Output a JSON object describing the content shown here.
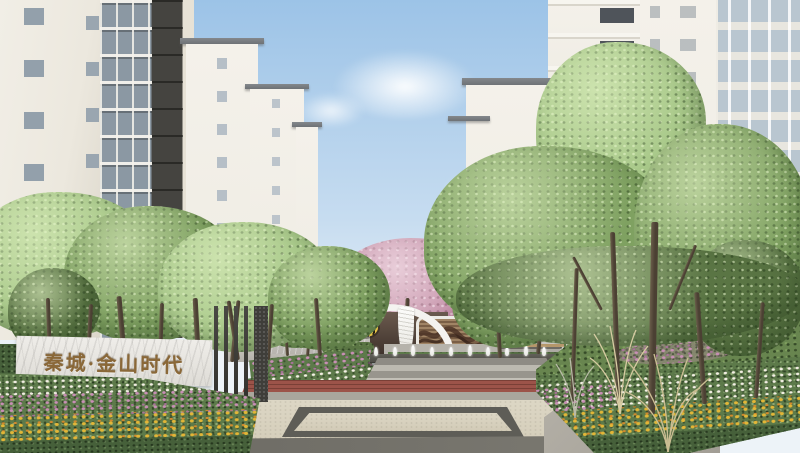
{
  "scene": {
    "sign": {
      "text": "秦城·金山时代"
    },
    "palette": {
      "sky_top": "#9cc3e7",
      "sky_mid": "#c6dcf0",
      "sky_horizon": "#edf3f8",
      "bldg_cream": "#ece8de",
      "bldg_dark": "#454440",
      "glass": "#8b98a3",
      "bldg_white": "#f0ede5",
      "roof_gray": "#6e7276",
      "leaf_light": "#a9c98a",
      "leaf_mid": "#7fa161",
      "leaf_dark": "#5a7544",
      "trunk": "#4b4033",
      "blossom": "#c998ae",
      "wall_stone": "#cbc8c1",
      "screen_wood": "#7a5f46",
      "screen_wave": "#4b3226",
      "canopy_white": "#f4f3f0",
      "emblem_yellow": "#e7c345",
      "bench_wood": "#b5976b",
      "ledge_dark": "#4b4a44",
      "paving_red": "#9c5349",
      "plaza_beige": "#ddd7c5",
      "inlay_dark": "#5e5d57",
      "paving_gray": "#b3afa6",
      "flower_white": "#f3efe4",
      "flower_pink": "#c98fb6",
      "flower_yellow": "#e2b637",
      "flower_orange": "#d08a2e",
      "bed_green": "#5d7a4a",
      "bed_green_dark": "#46603a",
      "grass_tan": "#d6cba2",
      "sign_marble": "#efede9",
      "sign_bronze": "#8a6838",
      "slat_dark": "#32312d"
    }
  }
}
